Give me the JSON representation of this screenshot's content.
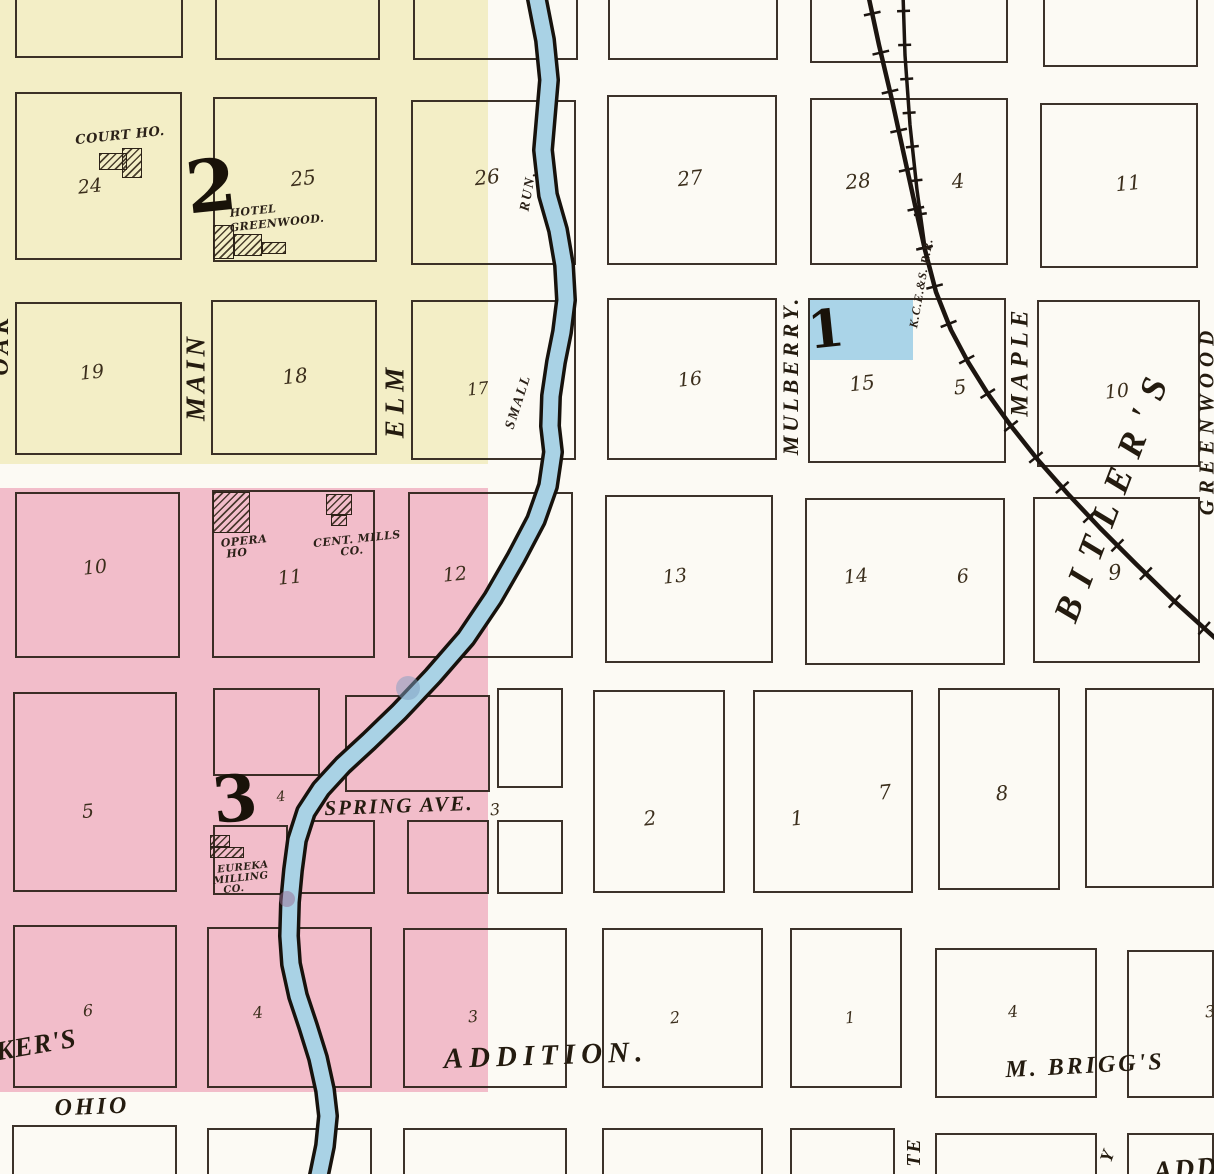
{
  "palette": {
    "paper": "#fcfaf4",
    "ink": "#2b2118",
    "script_ink": "#3b2e1c",
    "yellow_wash": "#f3eec6",
    "pink_wash": "#f2bdca",
    "blue_wash": "#aad4e8",
    "creek_fill": "#a9d2e5",
    "creek_edge": "#17120c",
    "rail": "#1c1510"
  },
  "washes": [
    {
      "n": "yellow-wash",
      "x": 0,
      "y": 0,
      "w": 488,
      "h": 464,
      "c": "yellow_wash"
    },
    {
      "n": "pink-wash",
      "x": 0,
      "y": 488,
      "w": 488,
      "h": 604,
      "c": "pink_wash"
    },
    {
      "n": "block1-blue-highlight",
      "x": 808,
      "y": 298,
      "w": 105,
      "h": 62,
      "c": "blue_wash"
    }
  ],
  "blocks": [
    [
      15,
      -40,
      168,
      98
    ],
    [
      215,
      -40,
      165,
      100
    ],
    [
      413,
      -40,
      165,
      100
    ],
    [
      608,
      -40,
      170,
      100
    ],
    [
      810,
      -40,
      198,
      103
    ],
    [
      1043,
      -40,
      155,
      107
    ],
    [
      15,
      92,
      167,
      168
    ],
    [
      213,
      97,
      164,
      165
    ],
    [
      411,
      100,
      165,
      165
    ],
    [
      607,
      95,
      170,
      170
    ],
    [
      810,
      98,
      198,
      167
    ],
    [
      1040,
      103,
      158,
      165
    ],
    [
      15,
      302,
      167,
      153
    ],
    [
      211,
      300,
      166,
      155
    ],
    [
      411,
      300,
      165,
      160
    ],
    [
      607,
      298,
      170,
      162
    ],
    [
      808,
      298,
      198,
      165
    ],
    [
      1037,
      300,
      163,
      167
    ],
    [
      15,
      492,
      165,
      166
    ],
    [
      212,
      490,
      163,
      168
    ],
    [
      408,
      492,
      165,
      166
    ],
    [
      605,
      495,
      168,
      168
    ],
    [
      805,
      498,
      200,
      167
    ],
    [
      1033,
      497,
      167,
      166
    ],
    [
      13,
      692,
      164,
      200
    ],
    [
      213,
      688,
      107,
      88
    ],
    [
      345,
      695,
      145,
      97
    ],
    [
      497,
      688,
      66,
      100
    ],
    [
      213,
      825,
      75,
      70
    ],
    [
      295,
      820,
      80,
      74
    ],
    [
      407,
      820,
      82,
      74
    ],
    [
      497,
      820,
      66,
      74
    ],
    [
      593,
      690,
      132,
      203
    ],
    [
      753,
      690,
      160,
      203
    ],
    [
      938,
      688,
      122,
      202
    ],
    [
      1085,
      688,
      129,
      200
    ],
    [
      13,
      925,
      164,
      163
    ],
    [
      207,
      927,
      165,
      161
    ],
    [
      403,
      928,
      164,
      160
    ],
    [
      602,
      928,
      161,
      160
    ],
    [
      790,
      928,
      112,
      160
    ],
    [
      935,
      948,
      162,
      150
    ],
    [
      1127,
      950,
      87,
      148
    ],
    [
      12,
      1125,
      165,
      60
    ],
    [
      207,
      1128,
      165,
      55
    ],
    [
      403,
      1128,
      164,
      55
    ],
    [
      602,
      1128,
      161,
      55
    ],
    [
      790,
      1128,
      105,
      55
    ],
    [
      935,
      1133,
      162,
      50
    ],
    [
      1127,
      1133,
      87,
      50
    ]
  ],
  "buildings": [
    {
      "n": "court-house-building",
      "rects": [
        [
          99,
          153,
          28,
          17
        ],
        [
          122,
          148,
          20,
          30
        ]
      ]
    },
    {
      "n": "hotel-greenwood-building",
      "rects": [
        [
          213,
          225,
          21,
          34
        ],
        [
          234,
          234,
          28,
          22
        ],
        [
          262,
          242,
          24,
          12
        ]
      ]
    },
    {
      "n": "opera-house-building",
      "rects": [
        [
          213,
          492,
          37,
          41
        ]
      ]
    },
    {
      "n": "central-mills-building",
      "rects": [
        [
          326,
          494,
          26,
          21
        ],
        [
          331,
          515,
          16,
          11
        ]
      ]
    },
    {
      "n": "eureka-milling-building",
      "rects": [
        [
          210,
          835,
          20,
          12
        ],
        [
          210,
          847,
          34,
          11
        ]
      ]
    }
  ],
  "labels": [
    {
      "n": "lot-24",
      "cls": "script",
      "t": "24",
      "x": 90,
      "y": 187,
      "s": 19
    },
    {
      "n": "lot-25",
      "cls": "script",
      "t": "25",
      "x": 303,
      "y": 178,
      "s": 20
    },
    {
      "n": "lot-26",
      "cls": "script",
      "t": "26",
      "x": 487,
      "y": 177,
      "s": 20
    },
    {
      "n": "lot-27",
      "cls": "script",
      "t": "27",
      "x": 690,
      "y": 178,
      "s": 20
    },
    {
      "n": "lot-28",
      "cls": "script",
      "t": "28",
      "x": 858,
      "y": 181,
      "s": 20
    },
    {
      "n": "lot-4-ne",
      "cls": "script",
      "t": "4",
      "x": 958,
      "y": 181,
      "s": 20
    },
    {
      "n": "lot-11-ne",
      "cls": "script",
      "t": "11",
      "x": 1128,
      "y": 183,
      "s": 20
    },
    {
      "n": "lot-19",
      "cls": "script",
      "t": "19",
      "x": 92,
      "y": 373,
      "s": 19
    },
    {
      "n": "lot-18",
      "cls": "script",
      "t": "18",
      "x": 295,
      "y": 376,
      "s": 20
    },
    {
      "n": "lot-17",
      "cls": "script",
      "t": "17",
      "x": 478,
      "y": 390,
      "s": 17
    },
    {
      "n": "lot-16",
      "cls": "script",
      "t": "16",
      "x": 690,
      "y": 380,
      "s": 19
    },
    {
      "n": "lot-15",
      "cls": "script",
      "t": "15",
      "x": 862,
      "y": 383,
      "s": 20
    },
    {
      "n": "lot-5-e",
      "cls": "script",
      "t": "5",
      "x": 960,
      "y": 387,
      "s": 20
    },
    {
      "n": "lot-10-e",
      "cls": "script",
      "t": "10",
      "x": 1117,
      "y": 392,
      "s": 19
    },
    {
      "n": "lot-10",
      "cls": "script",
      "t": "10",
      "x": 95,
      "y": 568,
      "s": 19
    },
    {
      "n": "lot-11",
      "cls": "script",
      "t": "11",
      "x": 290,
      "y": 578,
      "s": 19
    },
    {
      "n": "lot-12",
      "cls": "script",
      "t": "12",
      "x": 455,
      "y": 575,
      "s": 19
    },
    {
      "n": "lot-13",
      "cls": "script",
      "t": "13",
      "x": 675,
      "y": 577,
      "s": 19
    },
    {
      "n": "lot-14",
      "cls": "script",
      "t": "14",
      "x": 856,
      "y": 577,
      "s": 19
    },
    {
      "n": "lot-6-e",
      "cls": "script",
      "t": "6",
      "x": 963,
      "y": 577,
      "s": 19
    },
    {
      "n": "lot-9-e",
      "cls": "script",
      "t": "9",
      "x": 1115,
      "y": 573,
      "s": 21
    },
    {
      "n": "lot-5",
      "cls": "script",
      "t": "5",
      "x": 88,
      "y": 812,
      "s": 19
    },
    {
      "n": "lot-4-s",
      "cls": "script",
      "t": "4",
      "x": 281,
      "y": 797,
      "s": 14
    },
    {
      "n": "lot-3-spring",
      "cls": "script",
      "t": "3",
      "x": 495,
      "y": 810,
      "s": 16
    },
    {
      "n": "lot-2",
      "cls": "script",
      "t": "2",
      "x": 650,
      "y": 818,
      "s": 20
    },
    {
      "n": "lot-1",
      "cls": "script",
      "t": "1",
      "x": 797,
      "y": 818,
      "s": 20
    },
    {
      "n": "lot-7",
      "cls": "script",
      "t": "7",
      "x": 885,
      "y": 792,
      "s": 20
    },
    {
      "n": "lot-8",
      "cls": "script",
      "t": "8",
      "x": 1002,
      "y": 793,
      "s": 20
    },
    {
      "n": "lot-6-s",
      "cls": "script",
      "t": "6",
      "x": 88,
      "y": 1011,
      "s": 16
    },
    {
      "n": "lot-4-sw",
      "cls": "script",
      "t": "4",
      "x": 258,
      "y": 1013,
      "s": 16
    },
    {
      "n": "lot-3-s",
      "cls": "script",
      "t": "3",
      "x": 473,
      "y": 1017,
      "s": 16
    },
    {
      "n": "lot-2-s",
      "cls": "script",
      "t": "2",
      "x": 675,
      "y": 1018,
      "s": 16
    },
    {
      "n": "lot-1-s",
      "cls": "script",
      "t": "1",
      "x": 850,
      "y": 1018,
      "s": 16
    },
    {
      "n": "lot-4-se",
      "cls": "script",
      "t": "4",
      "x": 1013,
      "y": 1012,
      "s": 16
    },
    {
      "n": "lot-3-se",
      "cls": "script",
      "t": "3",
      "x": 1210,
      "y": 1012,
      "s": 16
    },
    {
      "n": "street-main",
      "cls": "street",
      "t": "MAIN",
      "x": 196,
      "y": 377,
      "s": 27,
      "r": -90,
      "ls": 4
    },
    {
      "n": "street-elm",
      "cls": "street",
      "t": "ELM",
      "x": 395,
      "y": 400,
      "s": 27,
      "r": -90,
      "ls": 6
    },
    {
      "n": "street-mulberry",
      "cls": "street",
      "t": "MULBERRY.",
      "x": 791,
      "y": 375,
      "s": 22,
      "r": -90,
      "ls": 4
    },
    {
      "n": "street-maple",
      "cls": "street",
      "t": "MAPLE",
      "x": 1020,
      "y": 361,
      "s": 25,
      "r": -90,
      "ls": 5
    },
    {
      "n": "street-greenwood",
      "cls": "street",
      "t": "GREENWOOD",
      "x": 1207,
      "y": 420,
      "s": 21,
      "r": -90,
      "ls": 6
    },
    {
      "n": "street-oak-partial",
      "cls": "street",
      "t": "OAK",
      "x": 1,
      "y": 345,
      "s": 24,
      "r": -90,
      "ls": 4
    },
    {
      "n": "street-spring-ave",
      "cls": "street",
      "t": "SPRING AVE.",
      "x": 399,
      "y": 806,
      "s": 21,
      "r": -2,
      "ls": 2
    },
    {
      "n": "street-ohio",
      "cls": "street",
      "t": "OHIO",
      "x": 92,
      "y": 1107,
      "s": 24,
      "r": -2,
      "ls": 3
    },
    {
      "n": "street-te-partial",
      "cls": "street",
      "t": "TE",
      "x": 914,
      "y": 1152,
      "s": 20,
      "r": -90,
      "ls": 2
    },
    {
      "n": "street-y-partial",
      "cls": "street",
      "t": "Y",
      "x": 1107,
      "y": 1156,
      "s": 18,
      "r": -70
    },
    {
      "n": "creek-label-small",
      "cls": "flow",
      "t": "SMALL",
      "x": 519,
      "y": 402,
      "s": 14,
      "r": -72,
      "ls": 2
    },
    {
      "n": "creek-label-run",
      "cls": "flow",
      "t": "RUN.",
      "x": 529,
      "y": 191,
      "s": 14,
      "r": -80,
      "ls": 2
    },
    {
      "n": "railroad-label",
      "cls": "flow",
      "t": "K.C.E.&S. R.R.",
      "x": 921,
      "y": 283,
      "s": 12,
      "r": -80,
      "ls": 1
    },
    {
      "n": "area-addition",
      "cls": "area",
      "t": "ADDITION.",
      "x": 546,
      "y": 1056,
      "s": 29,
      "r": -2,
      "ls": 6
    },
    {
      "n": "area-m-briggs",
      "cls": "area",
      "t": "M. BRIGG'S",
      "x": 1085,
      "y": 1066,
      "s": 24,
      "r": -3,
      "ls": 3
    },
    {
      "n": "area-kers-partial",
      "cls": "area",
      "t": "KER'S",
      "x": 36,
      "y": 1045,
      "s": 27,
      "r": -10,
      "ls": 1
    },
    {
      "n": "area-bitlers",
      "cls": "area",
      "t": "BITLER'S",
      "x": 1113,
      "y": 493,
      "s": 36,
      "r": -69,
      "ls": 14
    },
    {
      "n": "area-add-partial",
      "cls": "area",
      "t": "ADD",
      "x": 1186,
      "y": 1170,
      "s": 28,
      "r": -5,
      "ls": 2
    },
    {
      "n": "bldg-court-ho-label",
      "cls": "bldg",
      "t": "COURT HO.",
      "x": 120,
      "y": 136,
      "s": 13
    },
    {
      "n": "bldg-hotel-label-line1",
      "cls": "bldg",
      "t": "HOTEL",
      "x": 253,
      "y": 211,
      "s": 11
    },
    {
      "n": "bldg-hotel-label-line2",
      "cls": "bldg",
      "t": "GREENWOOD.",
      "x": 277,
      "y": 223,
      "s": 11
    },
    {
      "n": "bldg-opera-label-line1",
      "cls": "bldg",
      "t": "OPERA",
      "x": 244,
      "y": 541,
      "s": 11
    },
    {
      "n": "bldg-opera-label-line2",
      "cls": "bldg",
      "t": "HO",
      "x": 237,
      "y": 553,
      "s": 11
    },
    {
      "n": "bldg-cent-mills-label-line1",
      "cls": "bldg",
      "t": "CENT. MILLS",
      "x": 357,
      "y": 539,
      "s": 11
    },
    {
      "n": "bldg-cent-mills-label-line2",
      "cls": "bldg",
      "t": "CO.",
      "x": 352,
      "y": 551,
      "s": 11
    },
    {
      "n": "bldg-eureka-label-line1",
      "cls": "bldg",
      "t": "EUREKA",
      "x": 243,
      "y": 868,
      "s": 10
    },
    {
      "n": "bldg-eureka-label-line2",
      "cls": "bldg",
      "t": "MILLING",
      "x": 241,
      "y": 879,
      "s": 10
    },
    {
      "n": "bldg-eureka-label-line3",
      "cls": "bldg",
      "t": "CO.",
      "x": 234,
      "y": 890,
      "s": 10
    },
    {
      "n": "block-number-2",
      "cls": "bignum",
      "t": "2",
      "x": 211,
      "y": 186,
      "s": 72
    },
    {
      "n": "block-number-3",
      "cls": "bignum",
      "t": "3",
      "x": 235,
      "y": 800,
      "s": 64
    },
    {
      "n": "block-number-1",
      "cls": "bignum",
      "t": "1",
      "x": 826,
      "y": 330,
      "s": 52
    }
  ],
  "creek": {
    "points": [
      [
        536,
        -6
      ],
      [
        545,
        40
      ],
      [
        549,
        80
      ],
      [
        543,
        150
      ],
      [
        548,
        195
      ],
      [
        558,
        230
      ],
      [
        564,
        265
      ],
      [
        566,
        300
      ],
      [
        562,
        332
      ],
      [
        556,
        362
      ],
      [
        551,
        396
      ],
      [
        550,
        426
      ],
      [
        553,
        452
      ],
      [
        548,
        486
      ],
      [
        536,
        520
      ],
      [
        516,
        558
      ],
      [
        493,
        598
      ],
      [
        466,
        638
      ],
      [
        433,
        676
      ],
      [
        399,
        712
      ],
      [
        369,
        741
      ],
      [
        343,
        765
      ],
      [
        321,
        789
      ],
      [
        306,
        812
      ],
      [
        297,
        840
      ],
      [
        293,
        870
      ],
      [
        290,
        902
      ],
      [
        289,
        936
      ],
      [
        291,
        964
      ],
      [
        298,
        996
      ],
      [
        308,
        1026
      ],
      [
        318,
        1058
      ],
      [
        325,
        1090
      ],
      [
        328,
        1116
      ],
      [
        325,
        1146
      ],
      [
        318,
        1180
      ]
    ],
    "blobs": [
      {
        "x": 408,
        "y": 688,
        "r": 12,
        "c": "#7f9dc2",
        "o": 0.5
      },
      {
        "x": 287,
        "y": 899,
        "r": 8,
        "c": "#9a6d93",
        "o": 0.5
      }
    ]
  },
  "railroad": {
    "main": [
      [
        868,
        -6
      ],
      [
        879,
        45
      ],
      [
        892,
        100
      ],
      [
        904,
        155
      ],
      [
        915,
        205
      ],
      [
        925,
        250
      ],
      [
        936,
        292
      ],
      [
        951,
        330
      ],
      [
        968,
        362
      ],
      [
        988,
        394
      ],
      [
        1011,
        426
      ],
      [
        1038,
        460
      ],
      [
        1068,
        494
      ],
      [
        1100,
        528
      ],
      [
        1136,
        564
      ],
      [
        1173,
        600
      ],
      [
        1215,
        638
      ]
    ],
    "siding": [
      [
        903,
        -6
      ],
      [
        905,
        55
      ],
      [
        910,
        125
      ],
      [
        917,
        190
      ],
      [
        925,
        248
      ]
    ]
  }
}
